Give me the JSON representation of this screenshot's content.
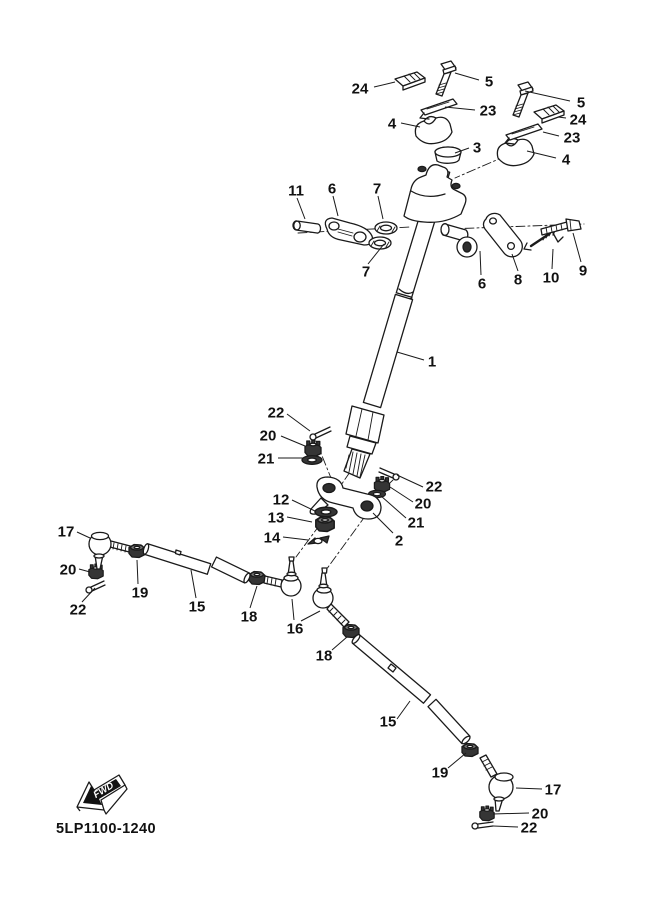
{
  "diagram": {
    "code": "5LP1100-1240",
    "fwd_label": "FWD",
    "colors": {
      "line": "#1a1a1a",
      "background": "#ffffff",
      "shaded_fill": "#2e2e2e"
    },
    "callouts": [
      {
        "n": "24",
        "x": 360,
        "y": 88,
        "leaders": [
          [
            374,
            87,
            395,
            82
          ]
        ]
      },
      {
        "n": "5",
        "x": 489,
        "y": 81,
        "leaders": [
          [
            479,
            80,
            455,
            73
          ]
        ]
      },
      {
        "n": "23",
        "x": 488,
        "y": 110,
        "leaders": [
          [
            475,
            110,
            445,
            107
          ]
        ]
      },
      {
        "n": "4",
        "x": 392,
        "y": 123,
        "leaders": [
          [
            401,
            123,
            420,
            127
          ]
        ]
      },
      {
        "n": "3",
        "x": 477,
        "y": 147,
        "leaders": [
          [
            469,
            148,
            455,
            153
          ]
        ]
      },
      {
        "n": "5",
        "x": 581,
        "y": 102,
        "leaders": [
          [
            570,
            101,
            525,
            91
          ]
        ]
      },
      {
        "n": "24",
        "x": 578,
        "y": 119,
        "leaders": [
          [
            566,
            118,
            558,
            117
          ]
        ]
      },
      {
        "n": "23",
        "x": 572,
        "y": 137,
        "leaders": [
          [
            559,
            136,
            543,
            132
          ]
        ]
      },
      {
        "n": "4",
        "x": 566,
        "y": 159,
        "leaders": [
          [
            556,
            158,
            527,
            151
          ]
        ]
      },
      {
        "n": "11",
        "x": 296,
        "y": 190,
        "leaders": [
          [
            297,
            198,
            305,
            219
          ]
        ]
      },
      {
        "n": "6",
        "x": 332,
        "y": 188,
        "leaders": [
          [
            333,
            196,
            338,
            216
          ]
        ]
      },
      {
        "n": "7",
        "x": 377,
        "y": 188,
        "leaders": [
          [
            378,
            196,
            383,
            219
          ]
        ]
      },
      {
        "n": "7",
        "x": 366,
        "y": 271,
        "leaders": [
          [
            368,
            264,
            384,
            244
          ]
        ]
      },
      {
        "n": "6",
        "x": 482,
        "y": 283,
        "leaders": [
          [
            481,
            275,
            480,
            251
          ]
        ]
      },
      {
        "n": "8",
        "x": 518,
        "y": 279,
        "leaders": [
          [
            518,
            271,
            512,
            254
          ]
        ]
      },
      {
        "n": "10",
        "x": 551,
        "y": 277,
        "leaders": [
          [
            552,
            269,
            553,
            249
          ]
        ]
      },
      {
        "n": "9",
        "x": 583,
        "y": 270,
        "leaders": [
          [
            581,
            262,
            573,
            233
          ]
        ]
      },
      {
        "n": "1",
        "x": 432,
        "y": 361,
        "leaders": [
          [
            424,
            360,
            397,
            352
          ]
        ]
      },
      {
        "n": "22",
        "x": 276,
        "y": 412,
        "leaders": [
          [
            287,
            414,
            310,
            431
          ]
        ]
      },
      {
        "n": "20",
        "x": 268,
        "y": 435,
        "leaders": [
          [
            281,
            436,
            305,
            446
          ]
        ]
      },
      {
        "n": "21",
        "x": 266,
        "y": 458,
        "leaders": [
          [
            278,
            458,
            303,
            458
          ]
        ]
      },
      {
        "n": "22",
        "x": 434,
        "y": 486,
        "leaders": [
          [
            423,
            487,
            397,
            475
          ]
        ]
      },
      {
        "n": "20",
        "x": 423,
        "y": 503,
        "leaders": [
          [
            413,
            502,
            390,
            487
          ]
        ]
      },
      {
        "n": "21",
        "x": 416,
        "y": 522,
        "leaders": [
          [
            406,
            518,
            381,
            496
          ]
        ]
      },
      {
        "n": "2",
        "x": 399,
        "y": 540,
        "leaders": [
          [
            393,
            533,
            373,
            513
          ]
        ]
      },
      {
        "n": "12",
        "x": 281,
        "y": 499,
        "leaders": [
          [
            292,
            500,
            315,
            511
          ]
        ]
      },
      {
        "n": "13",
        "x": 276,
        "y": 517,
        "leaders": [
          [
            287,
            517,
            312,
            522
          ]
        ]
      },
      {
        "n": "14",
        "x": 272,
        "y": 537,
        "leaders": [
          [
            283,
            537,
            308,
            540
          ]
        ]
      },
      {
        "n": "17",
        "x": 66,
        "y": 531,
        "leaders": [
          [
            77,
            532,
            90,
            538
          ]
        ]
      },
      {
        "n": "20",
        "x": 68,
        "y": 569,
        "leaders": [
          [
            79,
            569,
            90,
            572
          ]
        ]
      },
      {
        "n": "22",
        "x": 78,
        "y": 609,
        "leaders": [
          [
            82,
            602,
            95,
            588
          ]
        ]
      },
      {
        "n": "19",
        "x": 140,
        "y": 592,
        "leaders": [
          [
            138,
            584,
            137,
            560
          ]
        ]
      },
      {
        "n": "15",
        "x": 197,
        "y": 606,
        "leaders": [
          [
            196,
            598,
            191,
            570
          ]
        ]
      },
      {
        "n": "18",
        "x": 249,
        "y": 616,
        "leaders": [
          [
            250,
            608,
            257,
            586
          ]
        ]
      },
      {
        "n": "16",
        "x": 295,
        "y": 628,
        "leaders": [
          [
            294,
            620,
            292,
            599
          ],
          [
            301,
            621,
            320,
            611
          ]
        ]
      },
      {
        "n": "18",
        "x": 324,
        "y": 655,
        "leaders": [
          [
            332,
            650,
            347,
            637
          ]
        ]
      },
      {
        "n": "15",
        "x": 388,
        "y": 721,
        "leaders": [
          [
            397,
            719,
            410,
            701
          ]
        ]
      },
      {
        "n": "19",
        "x": 440,
        "y": 772,
        "leaders": [
          [
            448,
            768,
            466,
            753
          ]
        ]
      },
      {
        "n": "17",
        "x": 553,
        "y": 789,
        "leaders": [
          [
            542,
            789,
            516,
            788
          ]
        ]
      },
      {
        "n": "20",
        "x": 540,
        "y": 813,
        "leaders": [
          [
            529,
            813,
            493,
            814
          ]
        ]
      },
      {
        "n": "22",
        "x": 529,
        "y": 827,
        "leaders": [
          [
            518,
            827,
            493,
            826
          ]
        ]
      }
    ]
  }
}
